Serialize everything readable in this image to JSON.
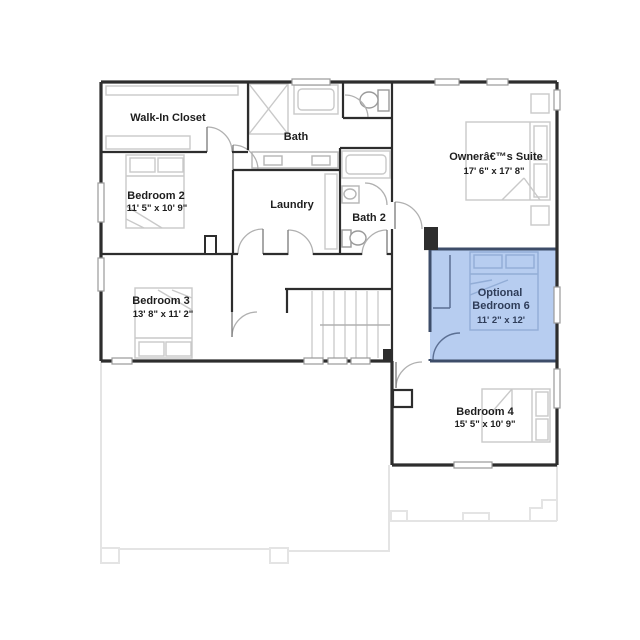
{
  "plan_title": "Second Floor Plan",
  "rooms": {
    "walk_in_closet": {
      "label": "Walk-In Closet"
    },
    "bath": {
      "label": "Bath"
    },
    "bedroom2": {
      "label": "Bedroom 2",
      "dimensions": "11' 5\" x 10' 9\""
    },
    "laundry": {
      "label": "Laundry"
    },
    "bath2": {
      "label": "Bath 2"
    },
    "owners_suite": {
      "label": "Ownerâ€™s Suite",
      "dimensions": "17' 6\" x 17' 8\""
    },
    "bedroom3": {
      "label": "Bedroom 3",
      "dimensions": "13' 8\" x 11' 2\""
    },
    "optional_bedroom6": {
      "line1": "Optional",
      "line2": "Bedroom 6",
      "dimensions": "11' 2\" x 12'",
      "highlighted": true
    },
    "bedroom4": {
      "label": "Bedroom 4",
      "dimensions": "15' 5\" x 10' 9\""
    }
  },
  "colors": {
    "wall": "#2d2d2d",
    "fixture_gray": "#c9c9c9",
    "door_arc": "#b0b0b0",
    "highlight_fill": "#b7cdf0",
    "highlight_wall": "#3d4d69",
    "highlight_fixture": "#92add6",
    "highlight_text": "#2f3d59",
    "ghost_outline": "#e4e4e4"
  }
}
